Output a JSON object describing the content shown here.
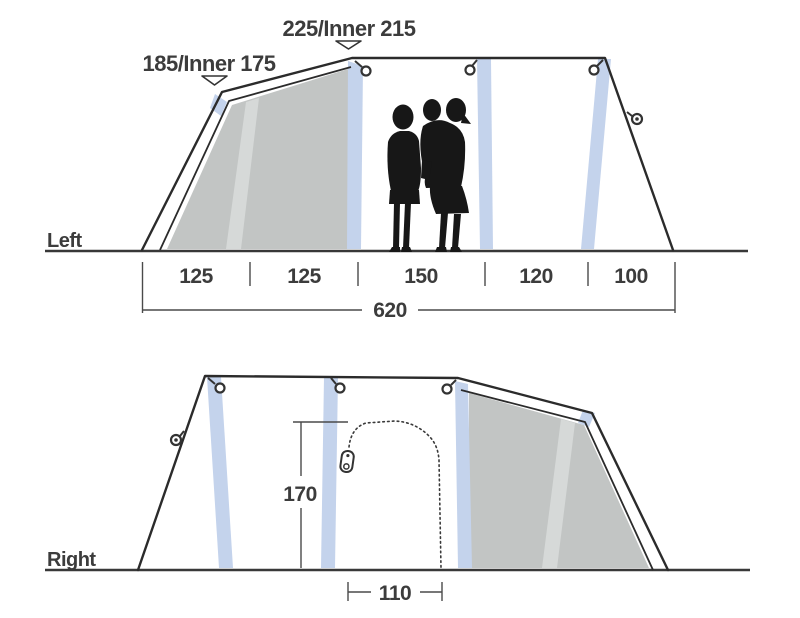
{
  "left_view": {
    "side_label": "Left",
    "peak_height_label": "185/Inner 175",
    "ridge_height_label": "225/Inner 215",
    "segment_labels": [
      "125",
      "125",
      "150",
      "120",
      "100"
    ],
    "total_width_label": "620"
  },
  "right_view": {
    "side_label": "Right",
    "door_height_label": "170",
    "door_width_label": "110"
  },
  "colors": {
    "pole_blue": "#c4d3ec",
    "panel_gray": "#c2c5c4",
    "panel_stripe": "#d6d9d8",
    "silhouette": "#171717"
  }
}
